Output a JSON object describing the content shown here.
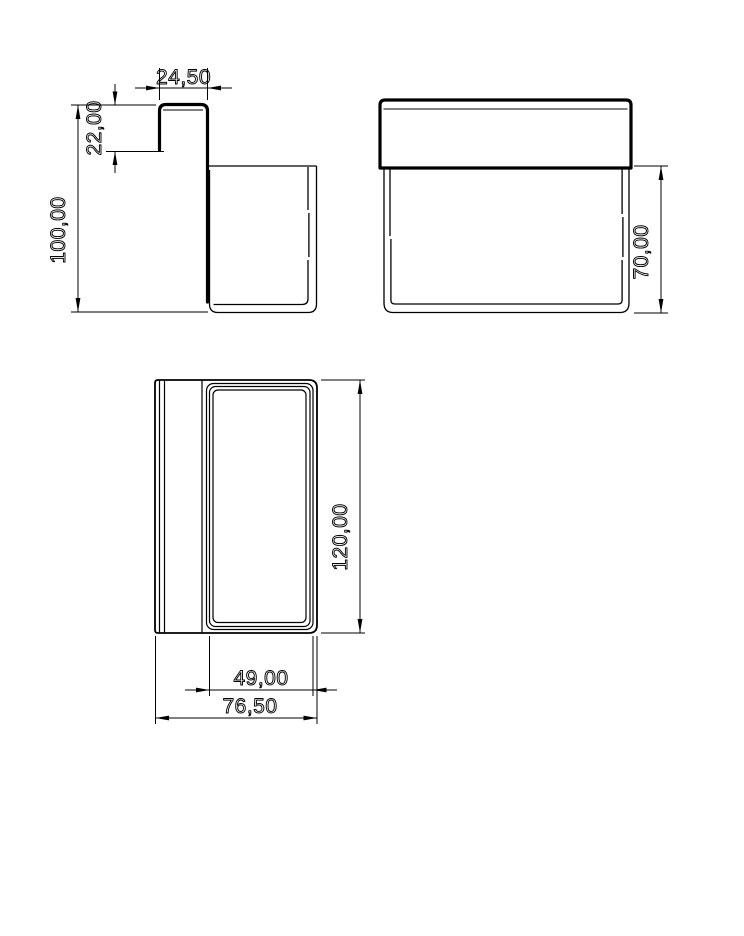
{
  "drawing": {
    "background_color": "#ffffff",
    "line_color": "#000000",
    "views": {
      "side": {
        "dims": {
          "hook_width": "24,50",
          "hook_drop": "22,00",
          "overall_height": "100,00"
        }
      },
      "front": {
        "dims": {
          "body_height": "70,00"
        }
      },
      "top": {
        "dims": {
          "length": "120,00",
          "opening_depth": "49,00",
          "overall_depth": "76,50"
        }
      }
    }
  }
}
